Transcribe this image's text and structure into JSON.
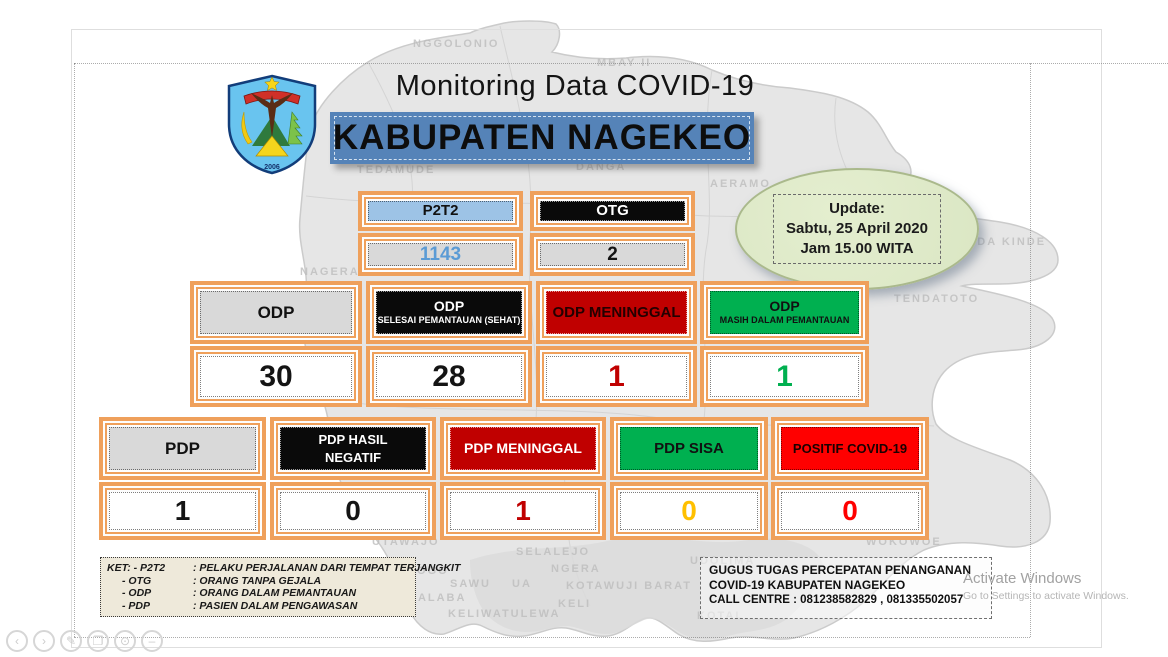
{
  "header": {
    "title": "Monitoring Data COVID-19",
    "banner": "KABUPATEN NAGEKEO"
  },
  "logo": {
    "year": "2006"
  },
  "update_box": {
    "title": "Update:",
    "date": "Sabtu, 25 April 2020",
    "time": "Jam 15.00 WITA"
  },
  "colors": {
    "frame_orange": "#efa05b",
    "banner_blue": "#5583b8",
    "header_gray": "#d9d9d9",
    "black": "#0a0a0a",
    "dark_red": "#c00000",
    "bright_red": "#ff0000",
    "green": "#00b050",
    "light_blue": "#9dc3e6",
    "value_blue": "#5b9bd5",
    "yellow": "#ffc000",
    "update_green": "#dae6c3"
  },
  "stats": {
    "row1": [
      {
        "id": "p2t2",
        "lines": [
          "P2T2"
        ],
        "header_bg": "#9dc3e6",
        "header_color": "#111111",
        "value": "1143",
        "value_color": "#5b9bd5"
      },
      {
        "id": "otg",
        "lines": [
          "OTG"
        ],
        "header_bg": "#0a0a0a",
        "header_color": "#ffffff",
        "value": "2",
        "value_color": "#141414"
      }
    ],
    "row2": [
      {
        "id": "odp",
        "lines": [
          "ODP"
        ],
        "header_bg": "#d9d9d9",
        "header_color": "#111111",
        "value": "30",
        "value_color": "#141414"
      },
      {
        "id": "odp-selesai",
        "lines": [
          "ODP",
          "SELESAI PEMANTAUAN (SEHAT)"
        ],
        "header_bg": "#0a0a0a",
        "header_color": "#ffffff",
        "value": "28",
        "value_color": "#141414"
      },
      {
        "id": "odp-meninggal",
        "lines": [
          "ODP MENINGGAL"
        ],
        "header_bg": "#c00000",
        "header_color": "#240000",
        "value": "1",
        "value_color": "#c00000"
      },
      {
        "id": "odp-masih",
        "lines": [
          "ODP",
          "MASIH DALAM PEMANTAUAN"
        ],
        "header_bg": "#00b050",
        "header_color": "#111111",
        "value": "1",
        "value_color": "#00b050"
      }
    ],
    "row3": [
      {
        "id": "pdp",
        "lines": [
          "PDP"
        ],
        "header_bg": "#d9d9d9",
        "header_color": "#111111",
        "value": "1",
        "value_color": "#141414"
      },
      {
        "id": "pdp-hasil-negatif",
        "lines": [
          "PDP HASIL",
          "NEGATIF"
        ],
        "stack": "equal",
        "header_bg": "#0a0a0a",
        "header_color": "#ffffff",
        "value": "0",
        "value_color": "#141414"
      },
      {
        "id": "pdp-meninggal",
        "lines": [
          "PDP MENINGGAL"
        ],
        "header_bg": "#c00000",
        "header_color": "#ffffff",
        "value": "1",
        "value_color": "#c00000"
      },
      {
        "id": "pdp-sisa",
        "lines": [
          "PDP SISA"
        ],
        "header_bg": "#00b050",
        "header_color": "#111111",
        "value": "0",
        "value_color": "#ffc000"
      },
      {
        "id": "positif-covid19",
        "lines": [
          "POSITIF COVID-19"
        ],
        "header_bg": "#ff0000",
        "header_color": "#1a0000",
        "value": "0",
        "value_color": "#ff0000"
      }
    ]
  },
  "legend": {
    "rows": [
      {
        "term": "KET: - P2T2",
        "def": ": PELAKU PERJALANAN DARI TEMPAT TERJANGKIT"
      },
      {
        "term": "- OTG",
        "def": ": ORANG TANPA GEJALA"
      },
      {
        "term": "- ODP",
        "def": ": ORANG DALAM PEMANTAUAN"
      },
      {
        "term": "- PDP",
        "def": ": PASIEN DALAM PENGAWASAN"
      }
    ]
  },
  "footer_box": {
    "line1": "GUGUS TUGAS PERCEPATAN PENANGANAN",
    "line2": "COVID-19 KABUPATEN NAGEKEO",
    "line3": "CALL CENTRE : 081238582829 , 081335502057"
  },
  "watermark": {
    "line1": "Activate Windows",
    "line2": "Go to Settings to activate Windows."
  },
  "map": {
    "labels": [
      {
        "text": "NGGOLONIO",
        "x": 413,
        "y": 38
      },
      {
        "text": "MBAY II",
        "x": 597,
        "y": 57
      },
      {
        "text": "TEDAMUDE",
        "x": 357,
        "y": 164
      },
      {
        "text": "DANGA",
        "x": 576,
        "y": 161
      },
      {
        "text": "AERAMO",
        "x": 710,
        "y": 178
      },
      {
        "text": "NAGERAWE",
        "x": 300,
        "y": 266
      },
      {
        "text": "OLAIA",
        "x": 838,
        "y": 264
      },
      {
        "text": "ENDA KINDE",
        "x": 958,
        "y": 236
      },
      {
        "text": "TENDATOTO",
        "x": 894,
        "y": 293
      },
      {
        "text": "GUPULU I",
        "x": 720,
        "y": 397
      },
      {
        "text": "UTAWAJO",
        "x": 372,
        "y": 536
      },
      {
        "text": "SELALEJO",
        "x": 516,
        "y": 546
      },
      {
        "text": "NGERA",
        "x": 551,
        "y": 563
      },
      {
        "text": "UDOLIMA",
        "x": 690,
        "y": 555
      },
      {
        "text": "WOKOWOE",
        "x": 866,
        "y": 536
      },
      {
        "text": "WAPOGO",
        "x": 386,
        "y": 565
      },
      {
        "text": "SAWU",
        "x": 450,
        "y": 578
      },
      {
        "text": "UA",
        "x": 512,
        "y": 578
      },
      {
        "text": "KALABA",
        "x": 408,
        "y": 592
      },
      {
        "text": "KELIWATULEWA",
        "x": 448,
        "y": 608
      },
      {
        "text": "KOTAWUJI BARAT",
        "x": 566,
        "y": 580
      },
      {
        "text": "KELI",
        "x": 558,
        "y": 598
      },
      {
        "text": "KOTAL",
        "x": 697,
        "y": 610
      }
    ]
  },
  "viewer_controls": {
    "buttons": [
      "previous-page",
      "next-page",
      "pen-tool",
      "snapshot",
      "magnifier",
      "collapse"
    ]
  }
}
